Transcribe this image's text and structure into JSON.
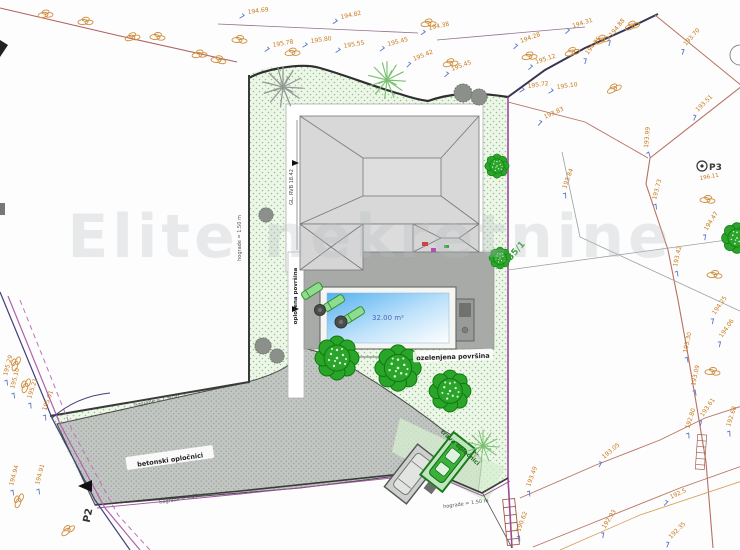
{
  "watermark": "Elite nekretnine",
  "plan": {
    "parcel_number": "135/1",
    "road_label": "P2",
    "benchmark": {
      "label": "P3",
      "elevation": "196.11"
    },
    "pool": {
      "area": "32.00 m²",
      "length": "8.00"
    },
    "house": {
      "dim": "GL. RVB 18.42"
    },
    "surfaces": {
      "paved": "opločena površina",
      "green": "ozelenjena površina",
      "concrete_pavers": "betonski opločnici",
      "grass_pavers": "trava opločnici",
      "fence_height": "hograde = 1.50 m"
    },
    "spot_heights": [
      {
        "t": "194.69",
        "x": 248,
        "y": 14,
        "r": -8
      },
      {
        "t": "194.82",
        "x": 341,
        "y": 19,
        "r": -12
      },
      {
        "t": "194.38",
        "x": 429,
        "y": 30,
        "r": -12
      },
      {
        "t": "194.28",
        "x": 521,
        "y": 43,
        "r": -20
      },
      {
        "t": "194.31",
        "x": 573,
        "y": 28,
        "r": -18
      },
      {
        "t": "195.78",
        "x": 273,
        "y": 47,
        "r": -10
      },
      {
        "t": "195.80",
        "x": 311,
        "y": 43,
        "r": -8
      },
      {
        "t": "195.55",
        "x": 344,
        "y": 48,
        "r": -10
      },
      {
        "t": "195.45",
        "x": 388,
        "y": 46,
        "r": -14
      },
      {
        "t": "195.42",
        "x": 414,
        "y": 61,
        "r": -22
      },
      {
        "t": "195.45",
        "x": 452,
        "y": 71,
        "r": -20
      },
      {
        "t": "195.12",
        "x": 536,
        "y": 64,
        "r": -18
      },
      {
        "t": "195.72",
        "x": 528,
        "y": 88,
        "r": -8
      },
      {
        "t": "195.10",
        "x": 557,
        "y": 89,
        "r": -8
      },
      {
        "t": "194.85",
        "x": 588,
        "y": 55,
        "r": -52
      },
      {
        "t": "194.88",
        "x": 612,
        "y": 37,
        "r": -52
      },
      {
        "t": "193.70",
        "x": 686,
        "y": 46,
        "r": -48
      },
      {
        "t": "193.51",
        "x": 698,
        "y": 112,
        "r": -45
      },
      {
        "t": "193.83",
        "x": 545,
        "y": 119,
        "r": -25
      },
      {
        "t": "193.84",
        "x": 566,
        "y": 189,
        "r": -70
      },
      {
        "t": "193.99",
        "x": 648,
        "y": 148,
        "r": -85
      },
      {
        "t": "193.73",
        "x": 656,
        "y": 200,
        "r": -75
      },
      {
        "t": "194.47",
        "x": 707,
        "y": 231,
        "r": -58
      },
      {
        "t": "193.42",
        "x": 677,
        "y": 267,
        "r": -78
      },
      {
        "t": "194.25",
        "x": 715,
        "y": 315,
        "r": -55
      },
      {
        "t": "194.06",
        "x": 722,
        "y": 338,
        "r": -55
      },
      {
        "t": "193.30",
        "x": 687,
        "y": 353,
        "r": -78
      },
      {
        "t": "193.09",
        "x": 695,
        "y": 386,
        "r": -78
      },
      {
        "t": "193.61",
        "x": 703,
        "y": 417,
        "r": -55
      },
      {
        "t": "192.80",
        "x": 689,
        "y": 429,
        "r": -72
      },
      {
        "t": "192.68",
        "x": 730,
        "y": 427,
        "r": -72
      },
      {
        "t": "193.05",
        "x": 604,
        "y": 459,
        "r": -40
      },
      {
        "t": "192.5",
        "x": 671,
        "y": 499,
        "r": -25
      },
      {
        "t": "192.93",
        "x": 605,
        "y": 529,
        "r": -58
      },
      {
        "t": "192.35",
        "x": 671,
        "y": 539,
        "r": -45
      },
      {
        "t": "193.49",
        "x": 530,
        "y": 487,
        "r": -70
      },
      {
        "t": "190.62",
        "x": 520,
        "y": 532,
        "r": -70
      },
      {
        "t": "195.29",
        "x": 7,
        "y": 376,
        "r": -75
      },
      {
        "t": "195.10",
        "x": 14,
        "y": 389,
        "r": -75
      },
      {
        "t": "195.21",
        "x": 31,
        "y": 399,
        "r": -72
      },
      {
        "t": "195.01",
        "x": 46,
        "y": 411,
        "r": -70
      },
      {
        "t": "194.94",
        "x": 13,
        "y": 486,
        "r": -75
      },
      {
        "t": "194.91",
        "x": 39,
        "y": 485,
        "r": -75
      }
    ],
    "rocks": [
      {
        "x": 43,
        "y": 15,
        "r": -10
      },
      {
        "x": 83,
        "y": 22,
        "r": -5
      },
      {
        "x": 130,
        "y": 38,
        "r": -15
      },
      {
        "x": 155,
        "y": 37,
        "r": 0
      },
      {
        "x": 197,
        "y": 55,
        "r": -10
      },
      {
        "x": 216,
        "y": 60,
        "r": 5
      },
      {
        "x": 237,
        "y": 40,
        "r": 0
      },
      {
        "x": 290,
        "y": 53,
        "r": -8
      },
      {
        "x": 426,
        "y": 24,
        "r": -10
      },
      {
        "x": 448,
        "y": 64,
        "r": -15
      },
      {
        "x": 527,
        "y": 57,
        "r": -10
      },
      {
        "x": 570,
        "y": 53,
        "r": -20
      },
      {
        "x": 600,
        "y": 41,
        "r": -25
      },
      {
        "x": 630,
        "y": 27,
        "r": -25
      },
      {
        "x": 612,
        "y": 90,
        "r": -30
      },
      {
        "x": 705,
        "y": 200,
        "r": 0
      },
      {
        "x": 712,
        "y": 275,
        "r": 0
      },
      {
        "x": 710,
        "y": 372,
        "r": 0
      },
      {
        "x": 15,
        "y": 366,
        "r": -70
      },
      {
        "x": 25,
        "y": 388,
        "r": -70
      },
      {
        "x": 18,
        "y": 503,
        "r": -70
      },
      {
        "x": 66,
        "y": 532,
        "r": -40
      }
    ],
    "trees": [
      {
        "k": "flower",
        "x": 337,
        "y": 358,
        "s": 1.0
      },
      {
        "k": "flower",
        "x": 398,
        "y": 368,
        "s": 1.05
      },
      {
        "k": "flower",
        "x": 450,
        "y": 391,
        "s": 0.95
      },
      {
        "k": "flower",
        "x": 497,
        "y": 166,
        "s": 0.55
      },
      {
        "k": "flower",
        "x": 737,
        "y": 238,
        "s": 0.7
      },
      {
        "k": "flower",
        "x": 500,
        "y": 258,
        "s": 0.5
      },
      {
        "k": "sketch",
        "x": 387,
        "y": 80,
        "s": 1.15
      },
      {
        "k": "sketch",
        "x": 483,
        "y": 446,
        "s": 1.0
      },
      {
        "k": "graysketch",
        "x": 283,
        "y": 87,
        "s": 1.25
      },
      {
        "k": "bush",
        "x": 266,
        "y": 215,
        "s": 0.8
      },
      {
        "k": "bush",
        "x": 263,
        "y": 346,
        "s": 0.9
      },
      {
        "k": "bush",
        "x": 277,
        "y": 356,
        "s": 0.8
      },
      {
        "k": "bush",
        "x": 463,
        "y": 93,
        "s": 1.0
      },
      {
        "k": "bush",
        "x": 479,
        "y": 97,
        "s": 0.9
      }
    ]
  },
  "colors": {
    "green_fill": "#edf6e9",
    "gray_paving": "#c2c6c2",
    "terrace": "#a7aaa7",
    "pool_blue": "#55b0f0",
    "boundary_purple": "#9a4a9a",
    "elevation_orange": "#c87818"
  }
}
